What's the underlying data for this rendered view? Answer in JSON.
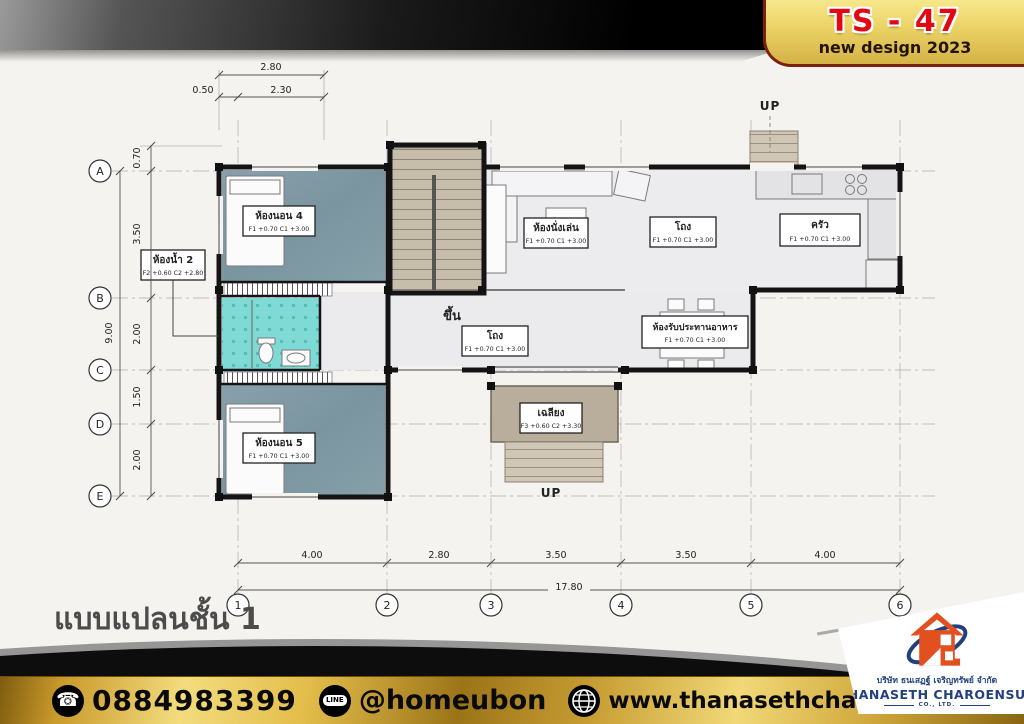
{
  "badge": {
    "model": "TS - 47",
    "subtitle": "new design 2023"
  },
  "plan": {
    "title": "แบบแปลนชั้น 1",
    "up_top": "UP",
    "up_bottom": "UP",
    "stair_up": "ขึ้น",
    "rooms": {
      "bedroom4": {
        "name": "ห้องนอน 4",
        "levels": "F1 +0.70 C1 +3.00"
      },
      "bath2": {
        "name": "ห้องน้ำ 2",
        "levels": "F2 +0.60 C2 +2.80"
      },
      "living": {
        "name": "ห้องนั่งเล่น",
        "levels": "F1 +0.70 C1 +3.00"
      },
      "hall_upper": {
        "name": "โถง",
        "levels": "F1 +0.70 C1 +3.00"
      },
      "kitchen": {
        "name": "ครัว",
        "levels": "F1 +0.70 C1 +3.00"
      },
      "hall_center": {
        "name": "โถง",
        "levels": "F1 +0.70 C1 +3.00"
      },
      "dining": {
        "name": "ห้องรับประทานอาหาร",
        "levels": "F1 +0.70 C1 +3.00"
      },
      "bedroom5": {
        "name": "ห้องนอน 5",
        "levels": "F1 +0.70 C1 +3.00"
      },
      "terrace": {
        "name": "เฉลียง",
        "levels": "F3 +0.60 C2 +3.30"
      }
    },
    "grid": {
      "rows": [
        "A",
        "B",
        "C",
        "D",
        "E"
      ],
      "cols": [
        "1",
        "2",
        "3",
        "4",
        "5",
        "6"
      ]
    },
    "dims": {
      "top": [
        "2.80",
        "0.50",
        "2.30"
      ],
      "left": [
        "0.70",
        "3.50",
        "2.00",
        "1.50",
        "2.00"
      ],
      "left_total": "9.00",
      "bottom": [
        "4.00",
        "2.80",
        "3.50",
        "3.50",
        "4.00"
      ],
      "bottom_total": "17.80"
    }
  },
  "footer": {
    "phone": "0884983399",
    "line_label": "LINE",
    "line_id": "@homeubon",
    "website": "www.thanasethcharoehsup.co.th",
    "company_th": "บริษัท ธนเสฏฐ์ เจริญทรัพย์ จำกัด",
    "company_en": "THANASETH CHAROENSUP",
    "company_suffix": "CO., LTD.",
    "icons": {
      "phone_glyph": "☎"
    }
  },
  "colors": {
    "gold": "#d4aa3c",
    "red": "#e30613",
    "navy": "#20407e",
    "orange": "#e2501f",
    "bedroom_floor": "#7e98a2",
    "bathroom_floor": "#7fd9d4",
    "hall_floor": "#ebebee",
    "stair_floor": "#c7bdab",
    "terrace_floor": "#b9ae9c"
  }
}
